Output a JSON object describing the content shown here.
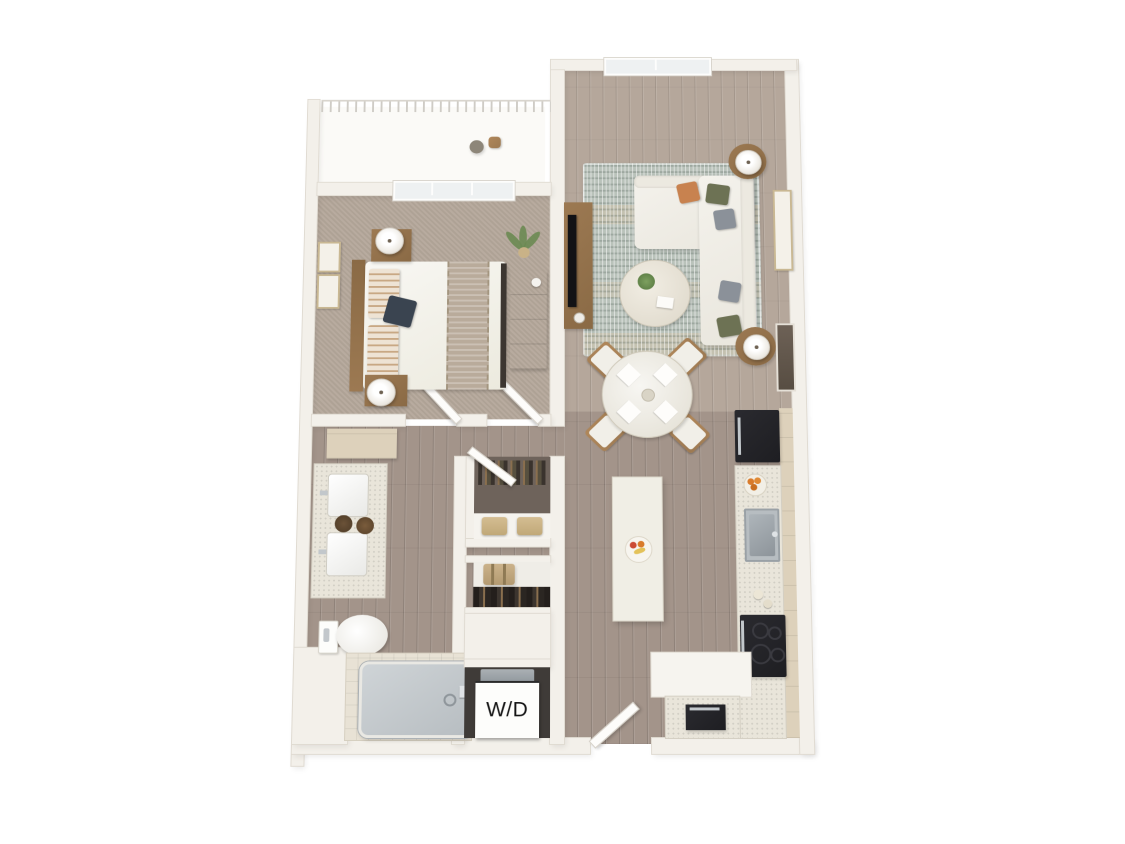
{
  "labels": {
    "washer_dryer": "W/D"
  },
  "colors": {
    "background": "#ffffff",
    "wall": "#f3f0ea",
    "wall_edge": "#e0dbd2",
    "wood": "#a3948a",
    "wood_light": "#b5a79b",
    "carpet": "#b4a79a",
    "closet_floor": "#6e635b",
    "rug_base": "#b9c2ba",
    "sofa_white": "#f2f0ea",
    "wood_furniture": "#9c7952",
    "appliance_black": "#1e1e22",
    "steel": "#c2c7cb",
    "counter": "#e9e5da",
    "cabinet_tan": "#ddd1bb",
    "island_white": "#f0eee5",
    "tub_steel": "#b7bdc1",
    "tile": "#e8e2d5",
    "pillow_olive": "#6d7254",
    "pillow_gray": "#8b9199",
    "pillow_rust": "#c8824f",
    "plant_green": "#6b8a52",
    "fruit_orange": "#d97b2b",
    "label_text": "#141414"
  },
  "rooms": {
    "balcony": {
      "items": [
        "railing",
        "bistro-table",
        "bistro-chair"
      ]
    },
    "bedroom": {
      "items": [
        "queen-bed",
        "wood-headboard",
        "white-duvet",
        "knit-throw-blanket",
        "navy-accent-pillow",
        "striped-pillows",
        "nightstand-with-lamp-upper",
        "nightstand-with-lamp-lower",
        "framed-wall-art-pair",
        "dresser",
        "potted-palm-plant",
        "window-to-balcony",
        "bedroom-door"
      ]
    },
    "living_room": {
      "items": [
        "l-shaped-sectional-sofa",
        "accent-pillows",
        "patterned-area-rug",
        "round-coffee-table",
        "media-console",
        "flat-screen-tv",
        "side-table-with-lamp-north",
        "side-table-with-lamp-south",
        "framed-wall-art",
        "wall-mirror",
        "picture-window"
      ]
    },
    "dining_area": {
      "items": [
        "round-dining-table",
        "dining-chairs-x4",
        "place-settings-x4"
      ]
    },
    "kitchen": {
      "items": [
        "refrigerator",
        "tall-pantry-cabinets",
        "speckled-countertop",
        "stainless-steel-sink",
        "electric-cooktop-range",
        "dishwasher",
        "kitchen-island",
        "fruit-plate",
        "orange-fruit-bowl",
        "garlic-bulbs",
        "return-counter"
      ]
    },
    "bathroom": {
      "items": [
        "double-sink-vanity",
        "vanity-trays",
        "linen-cabinet",
        "toilet",
        "bathtub",
        "tile-surround",
        "bathroom-door"
      ]
    },
    "walk_in_closet": {
      "items": [
        "hanging-clothes",
        "storage-baskets",
        "closet-door"
      ]
    },
    "coat_closet": {
      "items": [
        "suitcase",
        "hanging-coats"
      ]
    },
    "laundry_closet": {
      "items": [
        "stacked-washer-dryer"
      ]
    },
    "entry": {
      "items": [
        "entry-door"
      ]
    }
  }
}
